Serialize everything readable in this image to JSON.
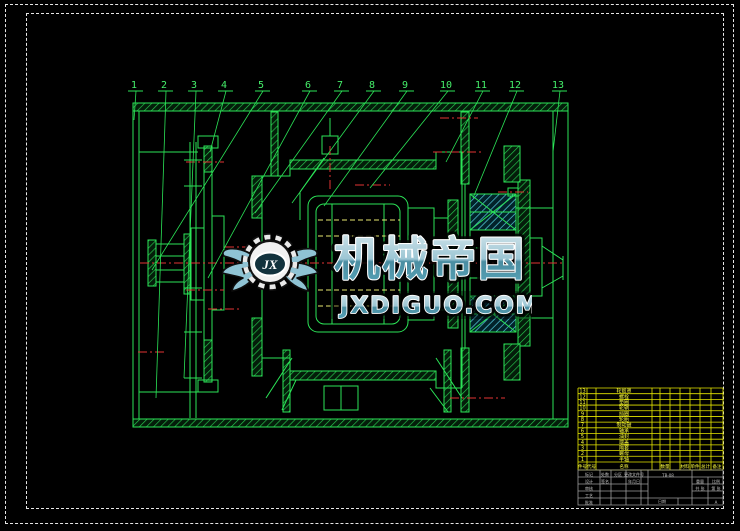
{
  "colors": {
    "background": "#000000",
    "line_green": "#2be457",
    "hatch_green": "#27c94e",
    "hatch_cyan": "#5fd9ee",
    "centerline_red": "#e23333",
    "hidden_yellow": "#e8e870",
    "bom_yellow": "#e6e600",
    "titleblock_gray": "#9b9b9b",
    "border_white": "#e6e6e6",
    "watermark_teal": "#5f9eb3"
  },
  "callouts": {
    "items": [
      {
        "label": "1",
        "x": 134,
        "ex": 134,
        "ey": 120
      },
      {
        "label": "2",
        "x": 164,
        "ex": 156,
        "ey": 398
      },
      {
        "label": "3",
        "x": 194,
        "ex": 184,
        "ey": 378
      },
      {
        "label": "4",
        "x": 224,
        "ex": 210,
        "ey": 152
      },
      {
        "label": "5",
        "x": 261,
        "ex": 152,
        "ey": 270
      },
      {
        "label": "6",
        "x": 308,
        "ex": 208,
        "ey": 278
      },
      {
        "label": "7",
        "x": 340,
        "ex": 255,
        "ey": 213
      },
      {
        "label": "8",
        "x": 372,
        "ex": 292,
        "ey": 203
      },
      {
        "label": "9",
        "x": 405,
        "ex": 324,
        "ey": 206
      },
      {
        "label": "10",
        "x": 446,
        "ex": 370,
        "ey": 188
      },
      {
        "label": "11",
        "x": 481,
        "ex": 446,
        "ey": 162
      },
      {
        "label": "12",
        "x": 515,
        "ex": 473,
        "ey": 198
      },
      {
        "label": "13",
        "x": 558,
        "ex": 553,
        "ey": 152
      }
    ]
  },
  "watermark": {
    "brand": "机械帝国",
    "domain": "JXDIGUO.COM",
    "monogram": "JX"
  },
  "bom": {
    "header": [
      {
        "label": "件号",
        "col": 0
      },
      {
        "label": "代号",
        "col": 1
      },
      {
        "label": "名称",
        "col": 2
      },
      {
        "label": "数量",
        "col": 4
      },
      {
        "label": "材料",
        "col": 6
      },
      {
        "label": "单件",
        "col": 7
      },
      {
        "label": "总计",
        "col": 8
      },
      {
        "label": "备注",
        "col": 9
      }
    ],
    "rows": [
      {
        "no": "13",
        "name": "轮毂罩"
      },
      {
        "no": "12",
        "name": "螺栓"
      },
      {
        "no": "11",
        "name": "垫圈"
      },
      {
        "no": "10",
        "name": "轮辋"
      },
      {
        "no": "9",
        "name": "挡圈"
      },
      {
        "no": "8",
        "name": "轮胎"
      },
      {
        "no": "7",
        "name": "制动鼓"
      },
      {
        "no": "6",
        "name": "轴承"
      },
      {
        "no": "5",
        "name": "油封"
      },
      {
        "no": "4",
        "name": "端盖"
      },
      {
        "no": "3",
        "name": "隔套"
      },
      {
        "no": "2",
        "name": "螺母"
      },
      {
        "no": "1",
        "name": "半轴"
      }
    ]
  },
  "title_block": {
    "texts": [
      {
        "t": "标记",
        "x": 589,
        "y": 476
      },
      {
        "t": "处数",
        "x": 605,
        "y": 476
      },
      {
        "t": "分区",
        "x": 618,
        "y": 476
      },
      {
        "t": "更改文件号",
        "x": 634,
        "y": 476
      },
      {
        "t": "设计",
        "x": 589,
        "y": 483
      },
      {
        "t": "签名",
        "x": 605,
        "y": 483
      },
      {
        "t": "年月日",
        "x": 634,
        "y": 483
      },
      {
        "t": "审核",
        "x": 589,
        "y": 490
      },
      {
        "t": "工艺",
        "x": 589,
        "y": 497
      },
      {
        "t": "批准",
        "x": 589,
        "y": 504
      },
      {
        "t": "TB-08",
        "x": 668,
        "y": 477,
        "size": 5
      },
      {
        "t": "重量",
        "x": 700,
        "y": 483
      },
      {
        "t": "比例",
        "x": 716,
        "y": 483
      },
      {
        "t": "共 张",
        "x": 700,
        "y": 490
      },
      {
        "t": "第 张",
        "x": 716,
        "y": 490
      },
      {
        "t": "日期",
        "x": 662,
        "y": 503
      },
      {
        "t": "A",
        "x": 716,
        "y": 504,
        "color": "#f0f000",
        "size": 6
      }
    ]
  }
}
